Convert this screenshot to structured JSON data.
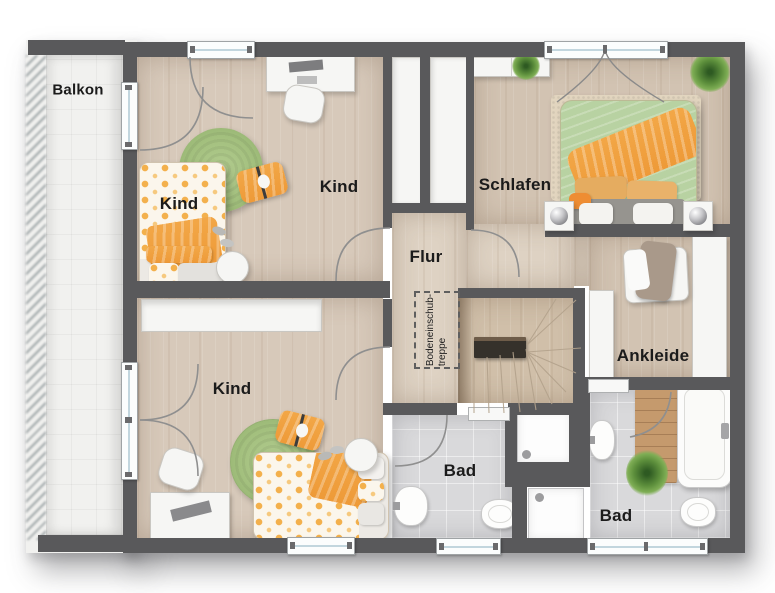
{
  "floorplan": {
    "labels": {
      "balkon": "Balkon",
      "kind_top_left": "Kind",
      "kind_top_right": "Kind",
      "schlafen": "Schlafen",
      "flur": "Flur",
      "kind_bottom": "Kind",
      "ankleide": "Ankleide",
      "bad_left": "Bad",
      "bad_right": "Bad",
      "attic_stair_line1": "Bodeneinschub-",
      "attic_stair_line2": "treppe"
    },
    "colors": {
      "wall": "#59595b",
      "wood_floor": "#d7c9ba",
      "wood_floor_dark": "#d2c3b2",
      "hall_floor": "#ded2c3",
      "stair_wood": "#d0bfa9",
      "bath_tile": "#d9d9db",
      "balcony_tile": "#f1f1ef",
      "rug_green": "#a3c07e",
      "accent_orange": "#f0a446",
      "duvet_green": "#b8d2a2",
      "label_text": "#1b1b1b"
    }
  }
}
